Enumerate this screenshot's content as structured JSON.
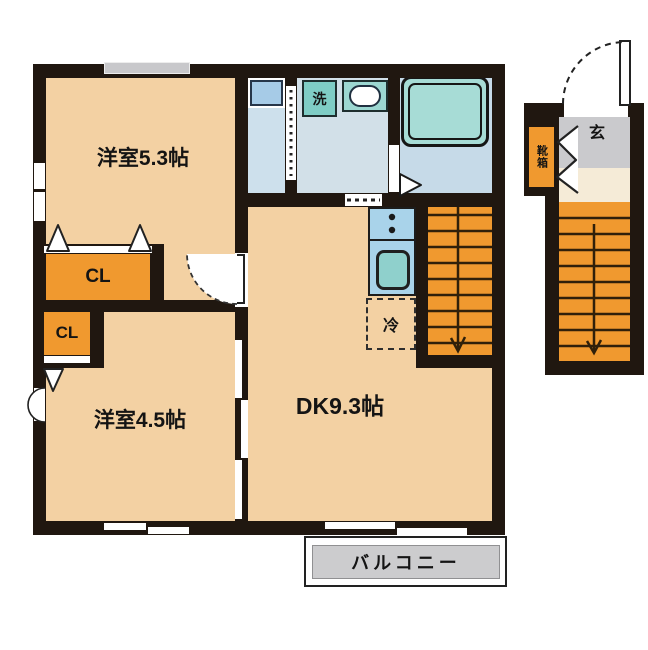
{
  "floorplan": {
    "unit_rooms": {
      "room_53": {
        "label": "洋室5.3帖"
      },
      "room_45": {
        "label": "洋室4.5帖"
      },
      "dk": {
        "label": "DK9.3帖"
      },
      "closet_1": {
        "label": "CL"
      },
      "closet_2": {
        "label": "CL"
      }
    },
    "fixtures": {
      "washer": {
        "label": "洗"
      },
      "fridge": {
        "label": "冷"
      }
    },
    "exterior": {
      "balcony": {
        "label": "バルコニー"
      },
      "entrance": {
        "label": "玄"
      },
      "shoebox": {
        "label": "靴箱"
      }
    },
    "stairs": {
      "internal_treads": 9,
      "external_treads": 9
    },
    "colors": {
      "floor_peach": "#f3d1a3",
      "closet_orange": "#f0992f",
      "stairs_orange": "#f0992f",
      "fixture_teal": "#9cd7d1",
      "bathtub_teal": "#a7dcd6",
      "water_floor_blue": "#d2e0e8",
      "kitchen_blue": "#a9d3ea",
      "entry_gray": "#cacacd",
      "balcony_gray": "#ccccce",
      "landing_cream": "#f5ebd7",
      "wall_black": "#201710"
    }
  }
}
